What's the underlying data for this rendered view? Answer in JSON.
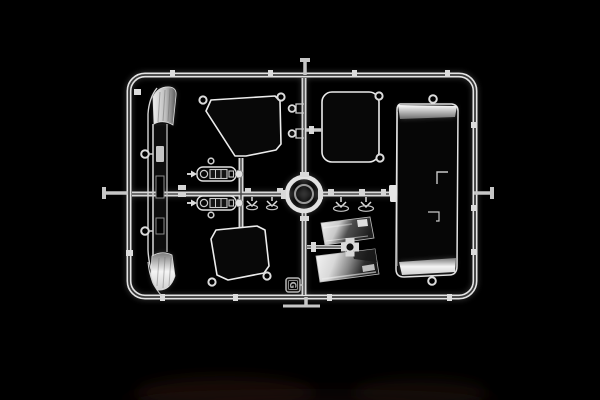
{
  "image": {
    "type": "product-photo",
    "subject": "Transparent clear-parts sprue from a plastic scale model kit photographed on a black background",
    "background_color": "#000000",
    "runner_highlight_color": "#e4e4e4",
    "runner_core_color": "#3a3a3a",
    "reflection_color": "#2a190a"
  },
  "sprue": {
    "letter": "G",
    "parts": [
      {
        "id": "windscreen-deflector",
        "label": "curved windscreen / deflector glass"
      },
      {
        "id": "door-window-upper",
        "label": "upper door window glass"
      },
      {
        "id": "door-window-lower",
        "label": "lower door window glass"
      },
      {
        "id": "side-window",
        "label": "side window glass"
      },
      {
        "id": "rear-window-panel",
        "label": "large rear window panel"
      },
      {
        "id": "mirror-glass-upper",
        "label": "upper mirror glass"
      },
      {
        "id": "mirror-glass-lower",
        "label": "lower mirror glass"
      },
      {
        "id": "roof-lamp-housing-upper",
        "label": "upper roof lamp housing"
      },
      {
        "id": "roof-lamp-housing-lower",
        "label": "lower roof lamp housing"
      },
      {
        "id": "small-lenses",
        "label": "small light lenses and clips"
      },
      {
        "id": "center-ring",
        "label": "central ring gate"
      }
    ]
  }
}
